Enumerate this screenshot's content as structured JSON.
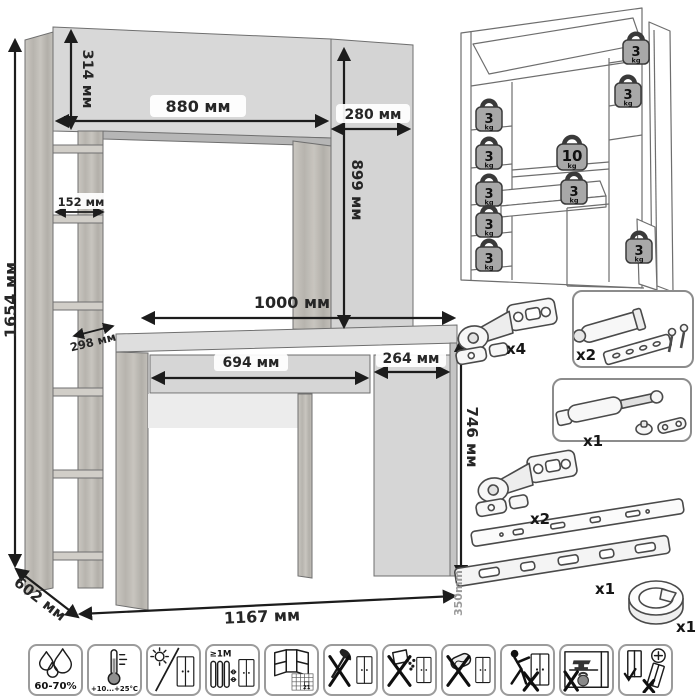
{
  "main_drawing": {
    "dims": {
      "total_height": "1654 мм",
      "hutch_height": "314 мм",
      "hutch_width": "880 мм",
      "hutch_side_width": "280 мм",
      "hutch_side_height": "899 мм",
      "shelf_width": "152 мм",
      "shelf_depth": "298 мм",
      "desktop_width": "1000 мм",
      "drawer_width": "694 мм",
      "pedestal_width": "264 мм",
      "desk_height": "746 мм",
      "depth": "602 мм",
      "total_width": "1167 мм"
    }
  },
  "load_diagram": {
    "weights": [
      {
        "value": "3",
        "unit": "kg"
      },
      {
        "value": "3",
        "unit": "kg"
      },
      {
        "value": "3",
        "unit": "kg"
      },
      {
        "value": "3",
        "unit": "kg"
      },
      {
        "value": "3",
        "unit": "kg"
      },
      {
        "value": "3",
        "unit": "kg"
      },
      {
        "value": "3",
        "unit": "kg"
      },
      {
        "value": "10",
        "unit": "kg"
      },
      {
        "value": "3",
        "unit": "kg"
      },
      {
        "value": "3",
        "unit": "kg"
      }
    ]
  },
  "hardware": {
    "items": [
      {
        "name": "concealed hinge",
        "qty": "x4"
      },
      {
        "name": "door damper",
        "qty": "x2"
      },
      {
        "name": "gas lift",
        "qty": "x1"
      },
      {
        "name": "concealed hinge",
        "qty": "x2"
      },
      {
        "name": "drawer slides",
        "qty": "x1",
        "length": "350mm"
      },
      {
        "name": "cable grommet",
        "qty": "x1"
      }
    ]
  },
  "care": {
    "humidity": "60-70%",
    "temperature": "+10...+25°C",
    "heat_distance": "≥1М",
    "calendar_day": "21"
  }
}
